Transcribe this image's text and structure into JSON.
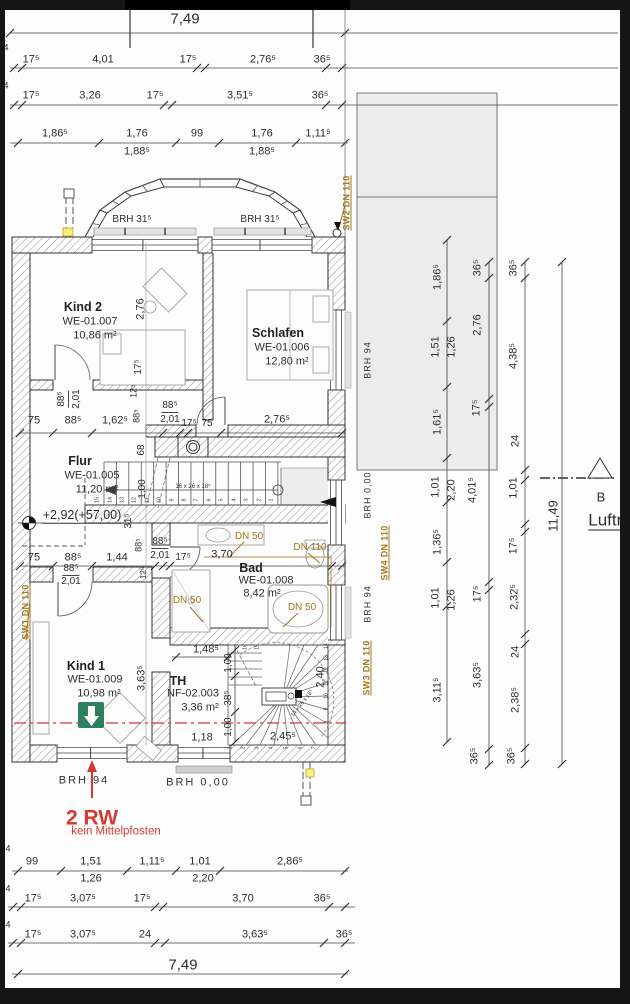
{
  "colors": {
    "annotation_orange": "#a2791d",
    "section_red": "#d23b2f",
    "exit_green": "#2c8060",
    "neighbor_gray": "#ececec"
  },
  "stairs": {
    "main": {
      "note": "16 x 26 x 18⁵",
      "treads": [
        "1",
        "2",
        "3",
        "4",
        "5",
        "6",
        "7",
        "8",
        "9",
        "10",
        "11",
        "12",
        "13",
        "14",
        "15"
      ]
    },
    "spiral": {
      "note": "14 x 26 x 18⁵",
      "treads": [
        "1",
        "2",
        "3",
        "4",
        "5",
        "6",
        "7",
        "8",
        "9",
        "10",
        "11",
        "12",
        "13",
        "14",
        "15",
        "16"
      ]
    }
  },
  "labels": [
    {
      "n": "dim-total-width-top",
      "t": "7,49",
      "x": 185,
      "y": 19,
      "s": 15
    },
    {
      "t": "4",
      "x": 6,
      "y": 48,
      "s": 9
    },
    {
      "t": "17⁵",
      "x": 31,
      "y": 60
    },
    {
      "t": "4,01",
      "x": 103,
      "y": 60
    },
    {
      "t": "17⁵",
      "x": 188,
      "y": 60
    },
    {
      "t": "2,76⁵",
      "x": 263,
      "y": 60
    },
    {
      "t": "36⁵",
      "x": 322,
      "y": 60
    },
    {
      "t": "4",
      "x": 6,
      "y": 86,
      "s": 9
    },
    {
      "t": "17⁵",
      "x": 31,
      "y": 96
    },
    {
      "t": "3,26",
      "x": 90,
      "y": 96
    },
    {
      "t": "17⁵",
      "x": 155,
      "y": 96
    },
    {
      "t": "3,51⁵",
      "x": 240,
      "y": 96
    },
    {
      "t": "36⁵",
      "x": 320,
      "y": 96
    },
    {
      "t": "1,86⁵",
      "x": 55,
      "y": 134
    },
    {
      "t": "1,76",
      "x": 137,
      "y": 134
    },
    {
      "t": "1,88⁵",
      "x": 137,
      "y": 152
    },
    {
      "t": "99",
      "x": 197,
      "y": 134
    },
    {
      "t": "1,76",
      "x": 262,
      "y": 134
    },
    {
      "t": "1,88⁵",
      "x": 262,
      "y": 152
    },
    {
      "t": "1,11⁵",
      "x": 318,
      "y": 134
    },
    {
      "n": "brh-bay-left",
      "t": "BRH  31⁵",
      "x": 132,
      "y": 220,
      "s": 10
    },
    {
      "n": "brh-bay-right",
      "t": "BRH  31⁵",
      "x": 260,
      "y": 220,
      "s": 10
    },
    {
      "n": "label-sw2",
      "t": "SW2 DN 110",
      "x": 347,
      "y": 203,
      "r": 1,
      "c": "or"
    },
    {
      "n": "room-kind2-name",
      "t": "Kind 2",
      "x": 83,
      "y": 307,
      "c": "b"
    },
    {
      "n": "room-kind2-code",
      "t": "WE-01.007",
      "x": 90,
      "y": 322
    },
    {
      "n": "room-kind2-area",
      "t": "10,86 m²",
      "x": 95,
      "y": 336
    },
    {
      "t": "2,76",
      "x": 141,
      "y": 309,
      "r": 1
    },
    {
      "t": "17⁵",
      "x": 139,
      "y": 367,
      "r": 1,
      "s": 10
    },
    {
      "n": "room-schlafen-name",
      "t": "Schlafen",
      "x": 278,
      "y": 333,
      "c": "b"
    },
    {
      "n": "room-schlafen-code",
      "t": "WE-01.006",
      "x": 282,
      "y": 348
    },
    {
      "n": "room-schlafen-area",
      "t": "12,80 m²",
      "x": 287,
      "y": 362
    },
    {
      "t": "88⁵",
      "x": 63,
      "y": 399,
      "r": 1,
      "c": "fr",
      "s": 10
    },
    {
      "t": "2,01",
      "x": 77,
      "y": 399,
      "r": 1,
      "s": 10
    },
    {
      "t": "12⁵",
      "x": 134,
      "y": 391,
      "r": 1,
      "s": 9
    },
    {
      "t": "88⁵",
      "x": 137,
      "y": 416,
      "r": 1,
      "s": 9
    },
    {
      "t": "75",
      "x": 34,
      "y": 421
    },
    {
      "t": "88⁵",
      "x": 73,
      "y": 421
    },
    {
      "t": "1,62⁵",
      "x": 115,
      "y": 421
    },
    {
      "t": "88⁵",
      "x": 170,
      "y": 407,
      "c": "fr",
      "s": 10
    },
    {
      "t": "2,01",
      "x": 170,
      "y": 420,
      "s": 10
    },
    {
      "t": "17⁵",
      "x": 189,
      "y": 424,
      "s": 10
    },
    {
      "t": "75",
      "x": 207,
      "y": 424,
      "s": 10
    },
    {
      "t": "2,76⁵",
      "x": 277,
      "y": 420
    },
    {
      "t": "68",
      "x": 142,
      "y": 450,
      "r": 1,
      "s": 10
    },
    {
      "n": "room-flur-name",
      "t": "Flur",
      "x": 80,
      "y": 461,
      "c": "b"
    },
    {
      "n": "room-flur-code",
      "t": "WE-01.005",
      "x": 92,
      "y": 476
    },
    {
      "n": "room-flur-area",
      "t": "11,20 m²",
      "x": 97,
      "y": 490
    },
    {
      "t": "1,00",
      "x": 143,
      "y": 489,
      "r": 1,
      "s": 10
    },
    {
      "n": "level-annotation",
      "t": "+2,92(+57,00)",
      "x": 82,
      "y": 516,
      "c": "lvl"
    },
    {
      "t": "31⁵",
      "x": 129,
      "y": 521,
      "r": 1,
      "s": 10
    },
    {
      "t": "88⁵",
      "x": 139,
      "y": 545,
      "r": 1,
      "s": 9
    },
    {
      "t": "88⁵",
      "x": 160,
      "y": 543,
      "c": "fr",
      "s": 10
    },
    {
      "t": "2,01",
      "x": 160,
      "y": 556,
      "s": 10
    },
    {
      "t": "17⁵",
      "x": 183,
      "y": 558,
      "s": 10
    },
    {
      "t": "75",
      "x": 34,
      "y": 558
    },
    {
      "t": "88⁵",
      "x": 73,
      "y": 558
    },
    {
      "t": "1,44",
      "x": 117,
      "y": 558
    },
    {
      "t": "12⁵",
      "x": 144,
      "y": 573,
      "r": 1,
      "s": 8
    },
    {
      "t": "3,70",
      "x": 222,
      "y": 555
    },
    {
      "n": "room-bad-name",
      "t": "Bad",
      "x": 251,
      "y": 568,
      "c": "b"
    },
    {
      "n": "room-bad-code",
      "t": "WE-01.008",
      "x": 266,
      "y": 581
    },
    {
      "n": "room-bad-area",
      "t": "8,42 m²",
      "x": 262,
      "y": 594
    },
    {
      "n": "label-dn50-basin",
      "t": "DN 50",
      "x": 249,
      "y": 537,
      "c": "or2"
    },
    {
      "n": "label-dn110-wc",
      "t": "DN 110",
      "x": 310,
      "y": 548,
      "c": "or2"
    },
    {
      "n": "label-dn50-shower",
      "t": "DN 50",
      "x": 187,
      "y": 601,
      "c": "or2"
    },
    {
      "n": "label-dn50-tub",
      "t": "DN 50",
      "x": 302,
      "y": 608,
      "c": "or2"
    },
    {
      "t": "88⁵",
      "x": 71,
      "y": 570,
      "c": "fr",
      "s": 10
    },
    {
      "t": "2,01",
      "x": 71,
      "y": 582,
      "s": 10
    },
    {
      "n": "label-sw1",
      "t": "SW1 DN 110",
      "x": 26,
      "y": 612,
      "r": 1,
      "c": "or"
    },
    {
      "n": "label-sw4",
      "t": "SW4 DN 110",
      "x": 385,
      "y": 553,
      "r": 1,
      "c": "or"
    },
    {
      "n": "label-sw3",
      "t": "SW3 DN 110",
      "x": 367,
      "y": 668,
      "r": 1,
      "c": "or"
    },
    {
      "n": "brh-schlafen-window",
      "t": "BRH  94",
      "x": 368,
      "y": 360,
      "r": 1,
      "c": "brh"
    },
    {
      "n": "brh-landing",
      "t": "BRH  0,00",
      "x": 368,
      "y": 495,
      "r": 1,
      "c": "brh"
    },
    {
      "n": "brh-bad-window",
      "t": "BRH  94",
      "x": 368,
      "y": 604,
      "r": 1,
      "c": "brh"
    },
    {
      "n": "room-kind1-name",
      "t": "Kind 1",
      "x": 86,
      "y": 666,
      "c": "b"
    },
    {
      "n": "room-kind1-code",
      "t": "WE-01.009",
      "x": 95,
      "y": 680
    },
    {
      "n": "room-kind1-area",
      "t": "10,98 m²",
      "x": 99,
      "y": 694
    },
    {
      "t": "3,63⁵",
      "x": 142,
      "y": 678,
      "r": 1
    },
    {
      "n": "room-th-name",
      "t": "TH",
      "x": 178,
      "y": 681,
      "c": "b"
    },
    {
      "n": "room-th-code",
      "t": "NF-02.003",
      "x": 193,
      "y": 694
    },
    {
      "n": "room-th-area",
      "t": "3,36 m²",
      "x": 200,
      "y": 708
    },
    {
      "t": "1,48⁵",
      "x": 206,
      "y": 650
    },
    {
      "t": "1,00",
      "x": 229,
      "y": 663,
      "r": 1,
      "s": 10
    },
    {
      "t": "38⁵",
      "x": 229,
      "y": 698,
      "r": 1,
      "s": 10
    },
    {
      "t": "1,00",
      "x": 229,
      "y": 727,
      "r": 1,
      "s": 10
    },
    {
      "t": "1,18",
      "x": 202,
      "y": 738
    },
    {
      "t": "2,45⁵",
      "x": 283,
      "y": 737
    },
    {
      "t": "2,40",
      "x": 321,
      "y": 677,
      "r": 1
    },
    {
      "n": "brh-kind1-window",
      "t": "BRH   94",
      "x": 84,
      "y": 781,
      "c": "brh2"
    },
    {
      "n": "brh-th-window",
      "t": "BRH   0,00",
      "x": 198,
      "y": 783,
      "c": "brh2"
    },
    {
      "n": "note-2rw",
      "t": "2 RW",
      "x": 92,
      "y": 818,
      "c": "redb"
    },
    {
      "n": "note-mittelpfosten",
      "t": "kein Mittelpfosten",
      "x": 116,
      "y": 832,
      "c": "reds"
    },
    {
      "t": "4",
      "x": 8,
      "y": 849,
      "s": 9
    },
    {
      "t": "99",
      "x": 32,
      "y": 862
    },
    {
      "t": "1,51",
      "x": 91,
      "y": 862
    },
    {
      "t": "1,11⁵",
      "x": 152,
      "y": 862
    },
    {
      "t": "1,01",
      "x": 200,
      "y": 862
    },
    {
      "t": "2,86⁵",
      "x": 290,
      "y": 862
    },
    {
      "t": "1,26",
      "x": 91,
      "y": 879
    },
    {
      "t": "2,20",
      "x": 203,
      "y": 879
    },
    {
      "t": "4",
      "x": 8,
      "y": 889,
      "s": 9
    },
    {
      "t": "17⁵",
      "x": 33,
      "y": 899
    },
    {
      "t": "3,07⁵",
      "x": 83,
      "y": 899
    },
    {
      "t": "17⁵",
      "x": 142,
      "y": 899
    },
    {
      "t": "3,70",
      "x": 243,
      "y": 899
    },
    {
      "t": "36⁵",
      "x": 322,
      "y": 899
    },
    {
      "t": "4",
      "x": 8,
      "y": 925,
      "s": 9
    },
    {
      "t": "17⁵",
      "x": 33,
      "y": 935
    },
    {
      "t": "3,07⁵",
      "x": 83,
      "y": 935
    },
    {
      "t": "24",
      "x": 145,
      "y": 935
    },
    {
      "t": "3,63⁵",
      "x": 255,
      "y": 935
    },
    {
      "t": "36⁵",
      "x": 344,
      "y": 935
    },
    {
      "n": "dim-total-width-bottom",
      "t": "7,49",
      "x": 183,
      "y": 965,
      "s": 15
    },
    {
      "t": "1,86⁵",
      "x": 438,
      "y": 277,
      "r": 1
    },
    {
      "t": "1,51",
      "x": 436,
      "y": 347,
      "r": 1
    },
    {
      "t": "1,26",
      "x": 452,
      "y": 347,
      "r": 1
    },
    {
      "t": "1,61⁵",
      "x": 438,
      "y": 422,
      "r": 1
    },
    {
      "t": "1,01",
      "x": 436,
      "y": 487,
      "r": 1
    },
    {
      "t": "2,20",
      "x": 452,
      "y": 490,
      "r": 1
    },
    {
      "t": "1,36⁵",
      "x": 438,
      "y": 542,
      "r": 1
    },
    {
      "t": "1,01",
      "x": 436,
      "y": 598,
      "r": 1
    },
    {
      "t": "1,26",
      "x": 452,
      "y": 600,
      "r": 1
    },
    {
      "t": "3,11⁵",
      "x": 438,
      "y": 690,
      "r": 1
    },
    {
      "t": "36⁵",
      "x": 478,
      "y": 268,
      "r": 1
    },
    {
      "t": "2,76",
      "x": 478,
      "y": 325,
      "r": 1
    },
    {
      "t": "17⁵",
      "x": 477,
      "y": 408,
      "r": 1
    },
    {
      "t": "4,01⁵",
      "x": 473,
      "y": 490,
      "r": 1
    },
    {
      "t": "17⁵",
      "x": 478,
      "y": 594,
      "r": 1
    },
    {
      "t": "3,63⁵",
      "x": 478,
      "y": 675,
      "r": 1
    },
    {
      "t": "36⁵",
      "x": 475,
      "y": 756,
      "r": 1
    },
    {
      "t": "36⁵",
      "x": 514,
      "y": 268,
      "r": 1
    },
    {
      "t": "4,38⁵",
      "x": 514,
      "y": 356,
      "r": 1
    },
    {
      "t": "24",
      "x": 516,
      "y": 441,
      "r": 1
    },
    {
      "t": "1,01",
      "x": 514,
      "y": 488,
      "r": 1
    },
    {
      "t": "17⁵",
      "x": 514,
      "y": 546,
      "r": 1
    },
    {
      "t": "2,32⁵",
      "x": 515,
      "y": 597,
      "r": 1
    },
    {
      "t": "24",
      "x": 516,
      "y": 652,
      "r": 1
    },
    {
      "t": "2,38⁵",
      "x": 516,
      "y": 700,
      "r": 1
    },
    {
      "t": "36⁵",
      "x": 512,
      "y": 756,
      "r": 1
    },
    {
      "n": "dim-total-height",
      "t": "11,49",
      "x": 553,
      "y": 516,
      "r": 1,
      "s": 13
    },
    {
      "n": "section-marker-b",
      "t": "B",
      "x": 601,
      "y": 497,
      "s": 13
    },
    {
      "n": "label-luftraum",
      "t": "Luftra",
      "x": 610,
      "y": 521,
      "c": "luft"
    }
  ]
}
